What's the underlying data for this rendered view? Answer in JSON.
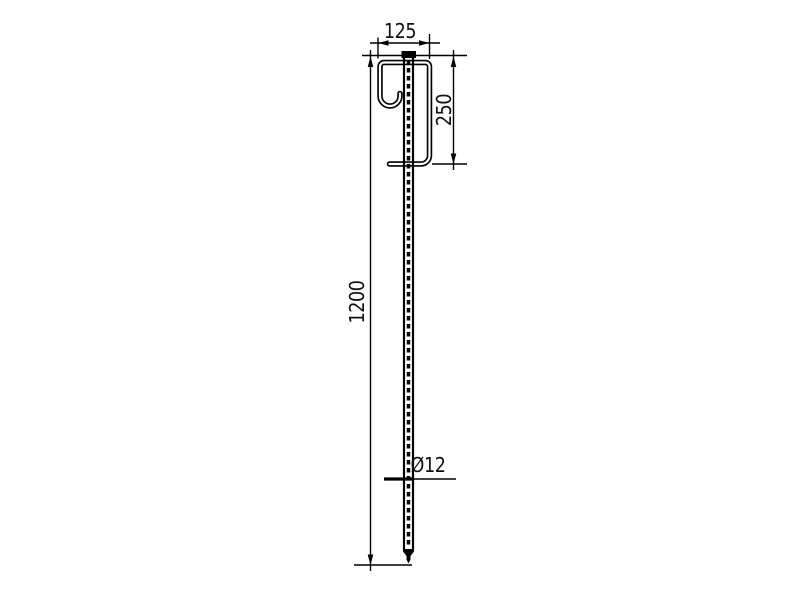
{
  "canvas": {
    "background": "#ffffff",
    "line_color": "#000000"
  },
  "drawing": {
    "kind": "technical-dimension-drawing",
    "labels": {
      "top_width": "125",
      "hook_height": "250",
      "total_length": "1200",
      "diameter": "Ø12"
    }
  }
}
